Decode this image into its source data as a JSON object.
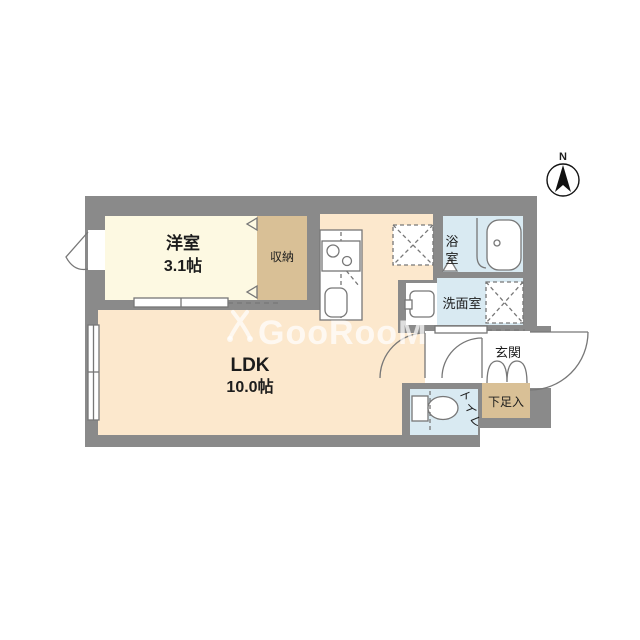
{
  "watermark": {
    "text": "GooRooM"
  },
  "compass": {
    "label": "N"
  },
  "rooms": {
    "western": {
      "name": "洋室",
      "size": "3.1帖"
    },
    "closet": {
      "name": "収納"
    },
    "ldk": {
      "name": "LDK",
      "size": "10.0帖"
    },
    "bath": {
      "name": "浴室",
      "chars": [
        "浴",
        "室"
      ]
    },
    "washroom": {
      "name": "洗面室"
    },
    "entrance": {
      "name": "玄関"
    },
    "shoebox": {
      "name": "下足入"
    },
    "toilet": {
      "name": "トイレ"
    }
  },
  "colors": {
    "wall": "#8a8a8a",
    "western_floor": "#fdf9e2",
    "ldk_floor": "#fce8cd",
    "closet_floor": "#d9c096",
    "wet_floor": "#d9eaf2",
    "fixture_line": "#777777"
  }
}
